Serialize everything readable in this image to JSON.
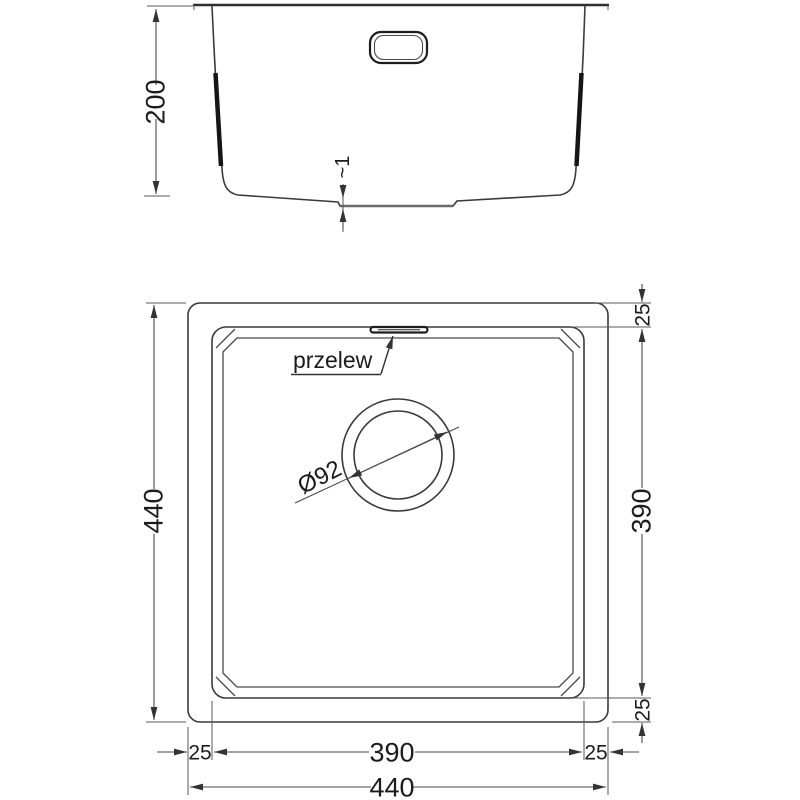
{
  "drawing": {
    "side_view": {
      "height_dim": "200",
      "base_recess_dim": "~1"
    },
    "plan_view": {
      "overall_width_dim": "440",
      "overall_depth_dim": "440",
      "bowl_width_dim": "390",
      "bowl_depth_dim": "390",
      "rim_top_dim": "25",
      "rim_bottom_dim": "25",
      "rim_left_dim": "25",
      "rim_right_dim": "25",
      "overflow_label": "przelew",
      "drain_diameter_dim": "Ø92"
    },
    "colors": {
      "background": "#ffffff",
      "outline": "#3a3a3a",
      "dimension": "#4a4a4a",
      "text": "#1c1c1c"
    }
  }
}
